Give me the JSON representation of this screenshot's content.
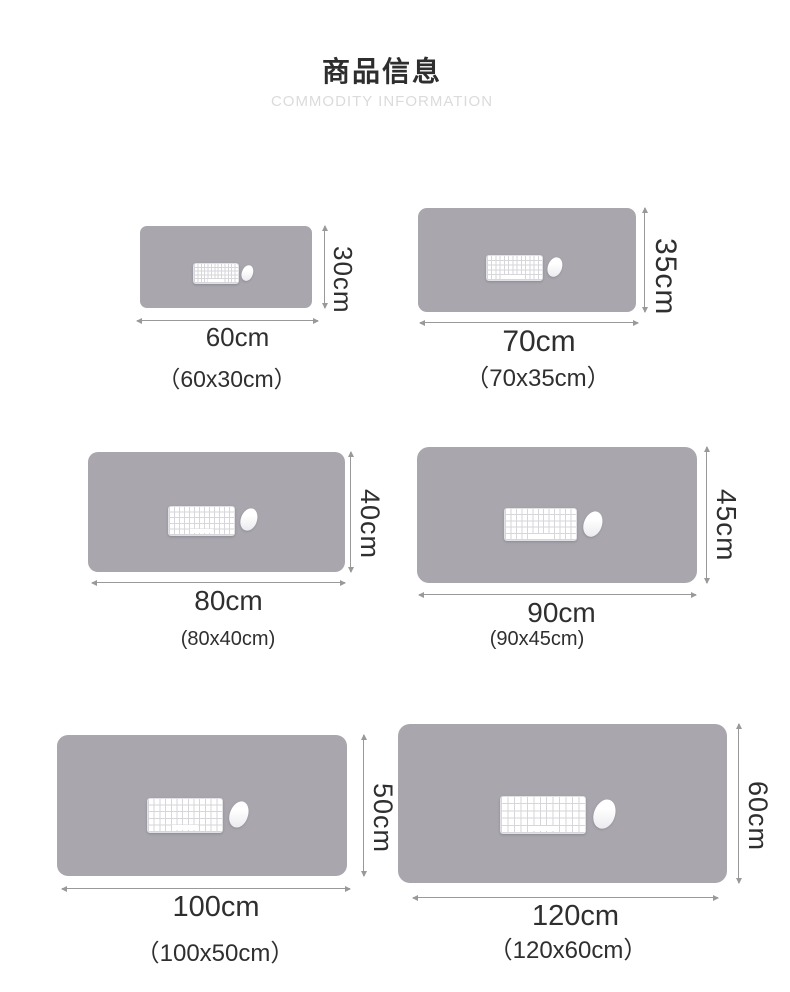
{
  "header": {
    "title_cn": "商品信息",
    "title_en": "COMMODITY INFORMATION"
  },
  "panels": [
    {
      "name": "60x30",
      "width_label": "60cm",
      "height_label": "30cm",
      "caption": "（60x30cm）"
    },
    {
      "name": "70x35",
      "width_label": "70cm",
      "height_label": "35cm",
      "caption": "（70x35cm）"
    },
    {
      "name": "80x40",
      "width_label": "80cm",
      "height_label": "40cm",
      "caption": "(80x40cm)"
    },
    {
      "name": "90x45",
      "width_label": "90cm",
      "height_label": "45cm",
      "caption": "(90x45cm)"
    },
    {
      "name": "100x50",
      "width_label": "100cm",
      "height_label": "50cm",
      "caption": "（100x50cm）"
    },
    {
      "name": "120x60",
      "width_label": "120cm",
      "height_label": "60cm",
      "caption": "（120x60cm）"
    }
  ],
  "colors": {
    "pad_gray": "#a7a4ab",
    "dimension_line": "#999999",
    "label_text": "#2f2f2f",
    "title_text": "#2e2e2e",
    "subtitle_text": "#dbdbdb",
    "keyboard": "#ffffff",
    "background": "#ffffff"
  }
}
